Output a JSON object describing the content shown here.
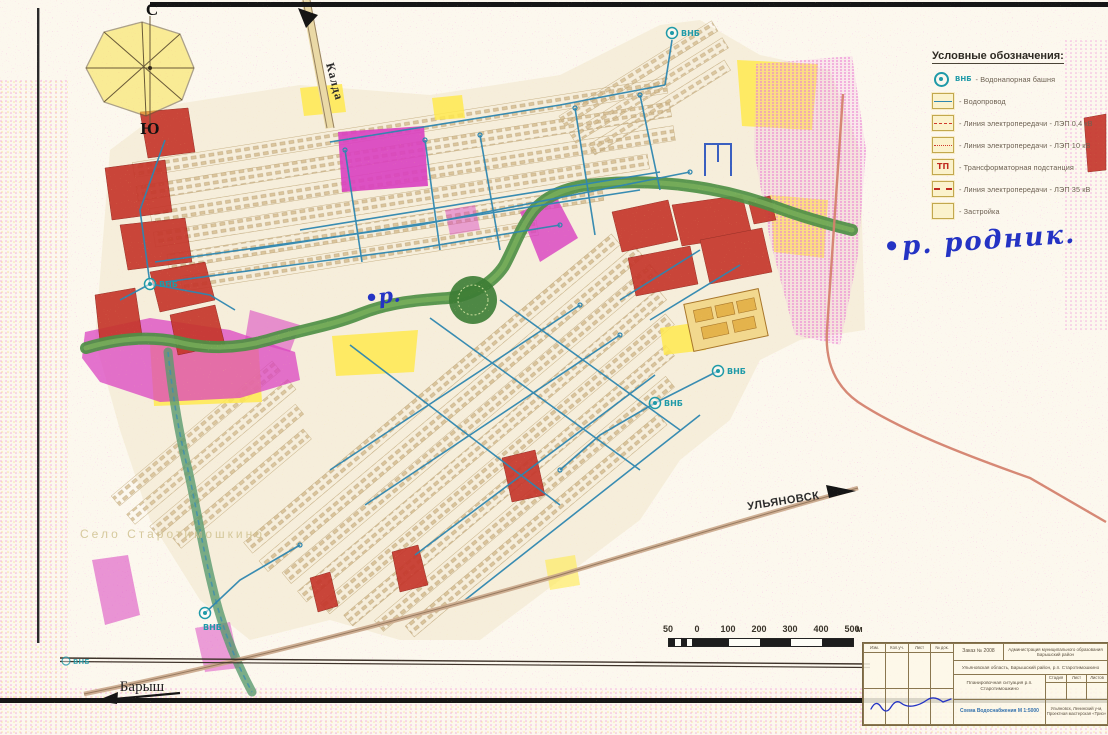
{
  "compass": {
    "north": "С",
    "south": "Ю"
  },
  "map_labels": {
    "kalda": "Калда",
    "ulyanovsk": "УЛЬЯНОВСК",
    "barysh": "Барыш",
    "village_faint": "Село Старотимошкино",
    "hand_r": "•р.",
    "hand_rodnik": "•р. родник.",
    "vnb": "ВНБ"
  },
  "legend": {
    "title": "Условные обозначения:",
    "items": [
      {
        "badge": "ВНБ",
        "label": "- Водонапорная башня"
      },
      {
        "label": "- Водопровод"
      },
      {
        "label": "- Линия электропередачи - ЛЭП 0,4 кВ"
      },
      {
        "label": "- Линия электропередачи - ЛЭП 10 кВ"
      },
      {
        "badge": "ТП",
        "label": "- Трансформаторная подстанция"
      },
      {
        "label": "- Линия электропередачи - ЛЭП 35 кВ"
      },
      {
        "label": "- Застройка"
      }
    ]
  },
  "scale_bar": {
    "labels": [
      "50",
      "0",
      "100",
      "200",
      "300",
      "400",
      "500"
    ],
    "unit": "м"
  },
  "title_block": {
    "order": "Заказ № 2008",
    "org": "Администрация муниципального образования Барышский район",
    "location": "Ульяновская область, Барышский район, р.п. Старотимошкино",
    "subject": "Планировочная ситуация р.п. Старотимошкино",
    "scheme": "Схема Водоснабжения М 1:5000",
    "firm": "Ульяновск, Ленинский у-м, Проектная мастерская «Трио»",
    "grid_headers": [
      "Изм.",
      "Кол.уч.",
      "Лист",
      "№ док."
    ],
    "stage_headers": [
      "Стадия",
      "Лист",
      "Листов"
    ]
  },
  "colors": {
    "water_pipe": "#2e86b0",
    "marker_teal": "#1f9aa8",
    "brick_red": "#c5372c",
    "magenta": "#d93fc0",
    "yellow": "#ffe94f",
    "river_green": "#4b8f43",
    "ink_blue": "#2433c4",
    "salmon": "#d4826e"
  }
}
